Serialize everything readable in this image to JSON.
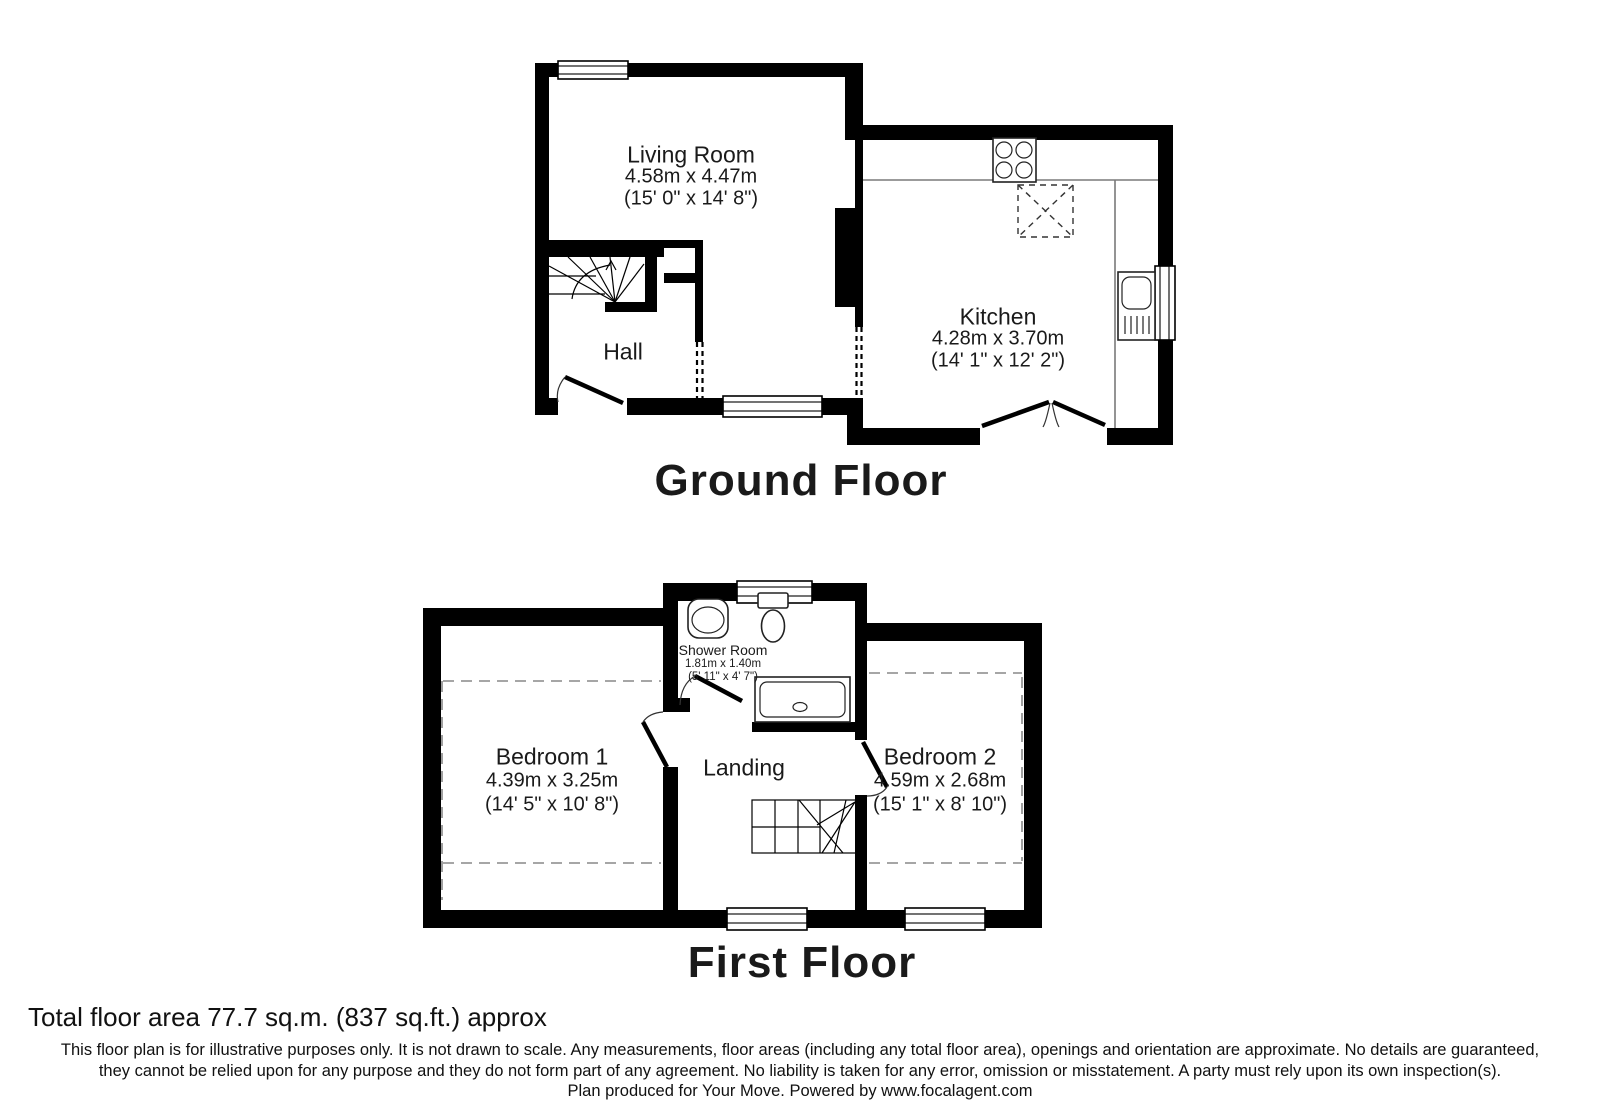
{
  "ground_floor": {
    "title": "Ground Floor",
    "living_room": {
      "name": "Living Room",
      "metric": "4.58m x 4.47m",
      "imperial": "(15' 0\" x 14' 8\")"
    },
    "kitchen": {
      "name": "Kitchen",
      "metric": "4.28m x 3.70m",
      "imperial": "(14' 1\" x 12' 2\")"
    },
    "hall": {
      "name": "Hall"
    }
  },
  "first_floor": {
    "title": "First Floor",
    "bedroom_1": {
      "name": "Bedroom 1",
      "metric": "4.39m x 3.25m",
      "imperial": "(14' 5\" x 10' 8\")"
    },
    "bedroom_2": {
      "name": "Bedroom 2",
      "metric": "4.59m x 2.68m",
      "imperial": "(15' 1\" x 8' 10\")"
    },
    "shower_room": {
      "name": "Shower Room",
      "metric": "1.81m x 1.40m",
      "imperial": "(5' 11\" x 4' 7\")"
    },
    "landing": {
      "name": "Landing"
    }
  },
  "footer": {
    "total_area": "Total floor area 77.7 sq.m. (837 sq.ft.) approx",
    "disclaimer_line_1": "This floor plan is for illustrative purposes only. It is not drawn to scale. Any measurements, floor areas (including any total floor area), openings and orientation are approximate. No details are guaranteed,",
    "disclaimer_line_2": "they cannot be relied upon for any purpose and they do not form part of any agreement. No liability is taken for any error, omission or misstatement. A party must rely upon its own inspection(s).",
    "credit": "Plan produced for Your Move. Powered by www.focalagent.com"
  },
  "colors": {
    "wall": "#000000",
    "counter": "#7a7a7a",
    "head_height_dash": "#888888"
  }
}
